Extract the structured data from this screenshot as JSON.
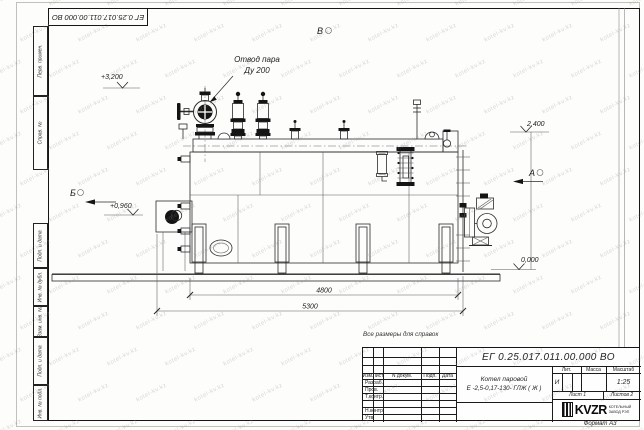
{
  "watermark": {
    "text": "kotel-kv.kz"
  },
  "frame": {
    "doc_number_top": "ЕГ 0.25.017.011.00.000  ВО",
    "stamps": [
      {
        "label": "Перв. примен."
      },
      {
        "label": "Справ. №"
      },
      {
        "label": "Подп. и дата"
      },
      {
        "label": "Инв. № дубл."
      },
      {
        "label": "Взам. инв. №"
      },
      {
        "label": "Подп. и дата"
      },
      {
        "label": "Инв. № подл."
      }
    ],
    "format_label": "Формат А3"
  },
  "drawing": {
    "reference_note": "Все размеры для справок",
    "steam_label_line1": "Отвод пара",
    "steam_label_line2": "Ду 200",
    "elevation_top": "+3,200",
    "elevation_right": "2,400",
    "elevation_burner": "+0,960",
    "elevation_ground": "0,000",
    "dim_inner": "4800",
    "dim_outer": "5300",
    "view_b": "Б",
    "view_v": "В",
    "view_a": "А"
  },
  "title_block": {
    "doc_number": "ЕГ 0.25.017.011.00.000  ВО",
    "product_line1": "Котел паровой",
    "product_line2": "Е -2,5-0,17-130- ГЛЖ ( Ж )",
    "col_izm": "Изм.",
    "col_list": "Лист",
    "col_doc": "N докум.",
    "col_podp": "Подп.",
    "col_data": "Дата",
    "row_razrab": "Разраб.",
    "row_prov": "Пров.",
    "row_tkontr": "Т.контр.",
    "row_nkontr": "Н.контр.",
    "row_utv": "Утв.",
    "lit_label": "Лит.",
    "mass_label": "Масса",
    "scale_label": "Масштаб",
    "lit_value": "И",
    "scale_value": "1:25",
    "sheet_label": "Лист 1",
    "sheets_label": "Листов 2",
    "logo_text": "KVZR",
    "company_line1": "КОТЕЛЬНЫЙ",
    "company_line2": "ЗАВОД РЭП"
  }
}
